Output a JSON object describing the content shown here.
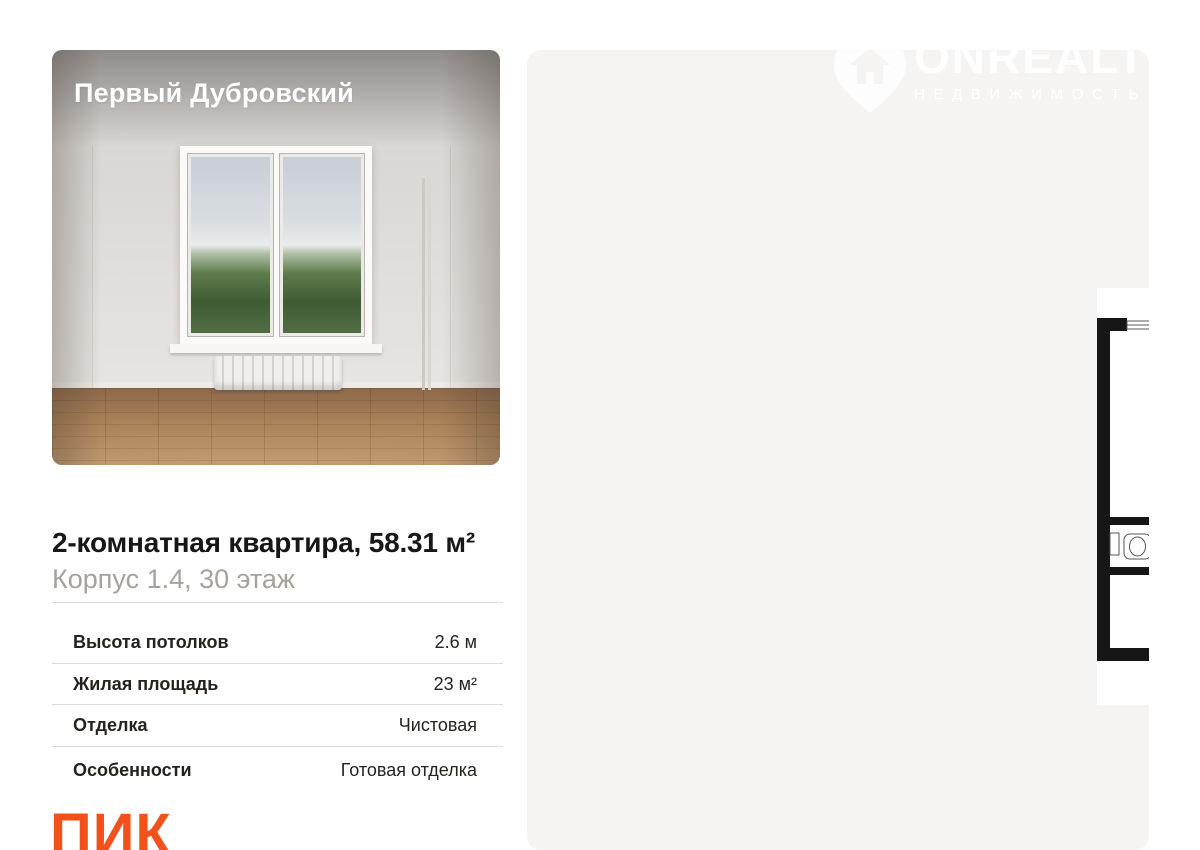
{
  "photo_card": {
    "project_name": "Первый Дубровский"
  },
  "listing": {
    "title": "2-комнатная квартира, 58.31 м²",
    "subtitle": "Корпус 1.4, 30 этаж",
    "specs": [
      {
        "label": "Высота потолков",
        "value": "2.6 м"
      },
      {
        "label": "Жилая площадь",
        "value": "23 м²"
      },
      {
        "label": "Отделка",
        "value": "Чистовая"
      },
      {
        "label": "Особенности",
        "value": "Готовая отделка"
      }
    ]
  },
  "developer": {
    "logo_text": "ПИК",
    "accent_color": "#F3511C"
  },
  "watermark": {
    "brand": "ONREALT",
    "tagline": "НЕДВИЖИМОСТЬ"
  },
  "floorplan": {
    "total_area": "58.31",
    "rooms": [
      {
        "name": "bedroom-1",
        "area": "11.1"
      },
      {
        "name": "kitchen-living-room",
        "area": "20.91"
      },
      {
        "name": "bedroom-2",
        "area": "11.9"
      },
      {
        "name": "wc",
        "area": "1.3"
      },
      {
        "name": "hallway",
        "area": "5.8"
      },
      {
        "name": "corridor",
        "area": "3.5"
      },
      {
        "name": "bathroom",
        "area": "3.8"
      }
    ]
  }
}
